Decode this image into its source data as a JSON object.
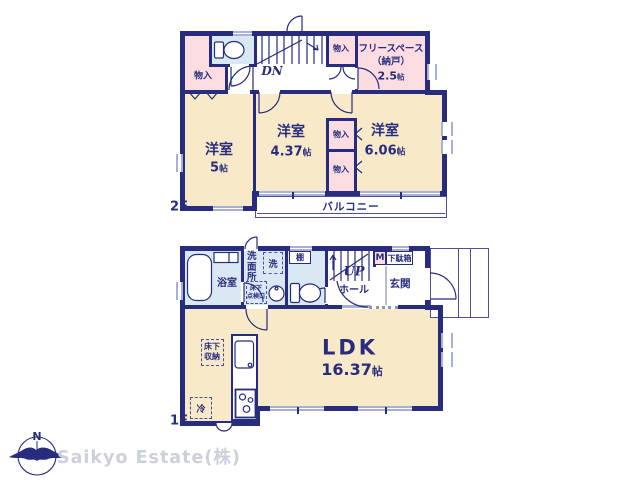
{
  "colors": {
    "wall": "#272c7e",
    "room_cream": "#f8eac8",
    "room_pink": "#fbdce1",
    "room_blue": "#d9e8f3",
    "thin_line": "#4a4f9b",
    "window_gray": "#a9b0d8",
    "logo_gray": "#ccd0db"
  },
  "floor2": {
    "label": "2F",
    "stairs": {
      "label": "DN"
    },
    "closet_label": "物入",
    "balcony": {
      "label": "バルコニー"
    },
    "rooms": {
      "bedroom_a": {
        "name": "洋室",
        "area": "5",
        "unit": "帖"
      },
      "bedroom_b": {
        "name": "洋室",
        "area": "4.37",
        "unit": "帖"
      },
      "bedroom_c": {
        "name": "洋室",
        "area": "6.06",
        "unit": "帖"
      },
      "freespace": {
        "line1": "フリースペース",
        "line2": "（納戸）",
        "area": "2.5",
        "unit": "帖"
      }
    }
  },
  "floor1": {
    "label": "1F",
    "stairs": {
      "label": "UP"
    },
    "rooms": {
      "bath": {
        "name": "浴室"
      },
      "washroom": {
        "name": "洗面所"
      },
      "toilet_shelf": {
        "name": "棚"
      },
      "hall": {
        "name": "ホール"
      },
      "entrance": {
        "name": "玄関"
      },
      "ldk": {
        "name": "LDK",
        "area": "16.37",
        "unit": "帖"
      }
    },
    "fixtures": {
      "washer": "洗",
      "inspection_l1": "床下",
      "inspection_l2": "点検口",
      "meter": "M",
      "shoebox": "下駄箱",
      "storage_l1": "床下",
      "storage_l2": "収納",
      "fridge": "冷"
    }
  },
  "footer": {
    "compass_n": "N",
    "company": "Saikyo Estate(株)"
  }
}
